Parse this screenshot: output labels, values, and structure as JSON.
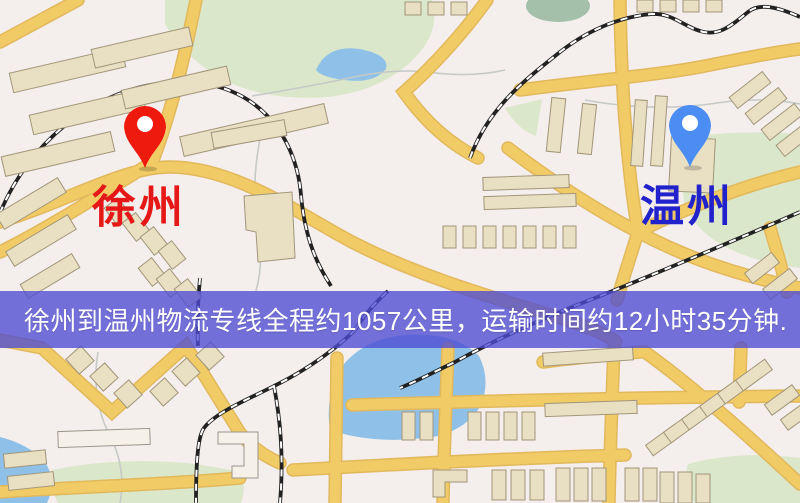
{
  "banner": {
    "text": "徐州到温州物流专线全程约1057公里，运输时间约12小时35分钟.",
    "background": "rgba(78,76,212,0.78)",
    "text_color": "#ffffff"
  },
  "origin": {
    "label": "徐州",
    "pin_color": "#ee1a0d",
    "label_color": "#e51717"
  },
  "destination": {
    "label": "温州",
    "pin_color": "#4b8df2",
    "label_color": "#2222cc"
  },
  "map_colors": {
    "background": "#f4eeec",
    "park": "#dbe7ca",
    "park_dark": "#a4c0ab",
    "water": "#8fc1e8",
    "road": "#f1cc66",
    "road_casing": "#e2b85c",
    "building": "#e9dfc2",
    "building_light": "#f5f1e8",
    "building_border": "#a2967a",
    "railway": "#222222",
    "railway_dash": "#ffffff",
    "stream": "#c6cac6",
    "pin_hole": "#ffffff"
  }
}
